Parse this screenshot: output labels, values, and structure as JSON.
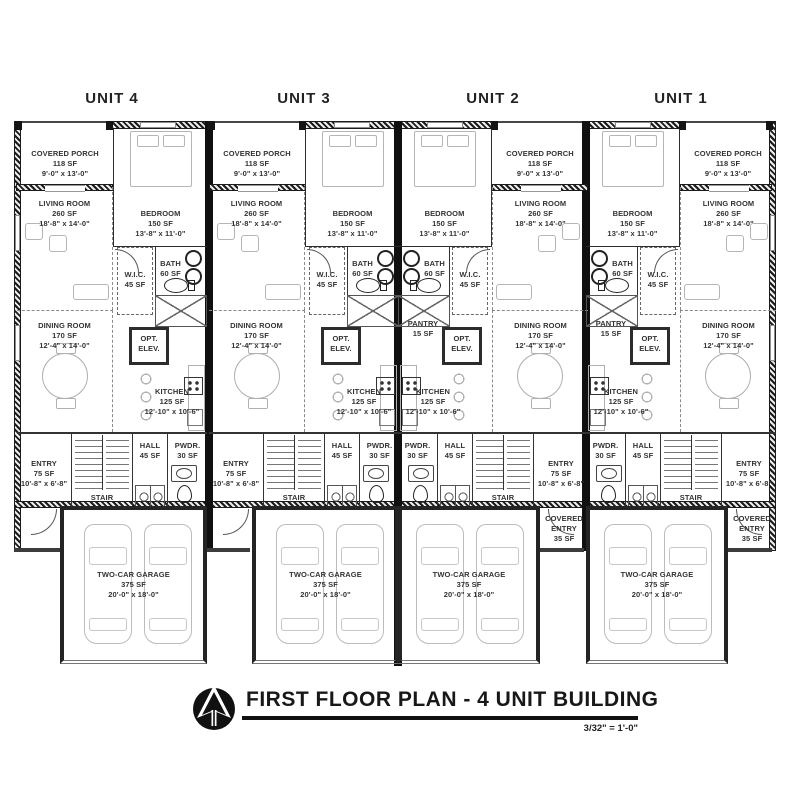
{
  "drawing": {
    "unit_labels": [
      "UNIT 4",
      "UNIT 3",
      "UNIT 2",
      "UNIT 1"
    ],
    "title": "FIRST FLOOR PLAN - 4 UNIT BUILDING",
    "scale": "3/32\" = 1'-0\"",
    "logo_icon": "north-arrow-icon"
  },
  "rooms": {
    "covered_porch": {
      "name": "COVERED PORCH",
      "area": "118 SF",
      "dims": "9'-0\" x 13'-0\""
    },
    "bedroom": {
      "name": "BEDROOM",
      "area": "150 SF",
      "dims": "13'-8\" x 11'-0\""
    },
    "living_room": {
      "name": "LIVING ROOM",
      "area": "260 SF",
      "dims": "18'-8\" x 14'-0\""
    },
    "wic": {
      "name": "W.I.C.",
      "area": "45 SF"
    },
    "bath": {
      "name": "BATH",
      "area": "60 SF"
    },
    "dining_room": {
      "name": "DINING ROOM",
      "area": "170 SF",
      "dims": "12'-4\" x 14'-0\""
    },
    "opt_elev": {
      "name": "OPT.",
      "name2": "ELEV."
    },
    "pantry": {
      "name": "PANTRY",
      "area": "15 SF"
    },
    "kitchen": {
      "name": "KITCHEN",
      "area": "125 SF",
      "dims": "12'-10\" x 10'-6\""
    },
    "entry": {
      "name": "ENTRY",
      "area": "75 SF",
      "dims": "10'-8\" x 6'-8\""
    },
    "stair": {
      "name": "STAIR"
    },
    "hall": {
      "name": "HALL",
      "area": "45 SF"
    },
    "pwdr": {
      "name": "PWDR.",
      "area": "30 SF"
    },
    "garage": {
      "name": "TWO-CAR GARAGE",
      "area": "375 SF",
      "dims": "20'-0\" x 18'-0\""
    },
    "covered_entry": {
      "name": "COVERED",
      "name2": "ENTRY",
      "area": "35 SF"
    }
  },
  "colors": {
    "wall": "#1b1b1b",
    "line": "#2c2c2c",
    "furniture": "#b5b5b5",
    "text": "#333333",
    "paper": "#ffffff"
  }
}
